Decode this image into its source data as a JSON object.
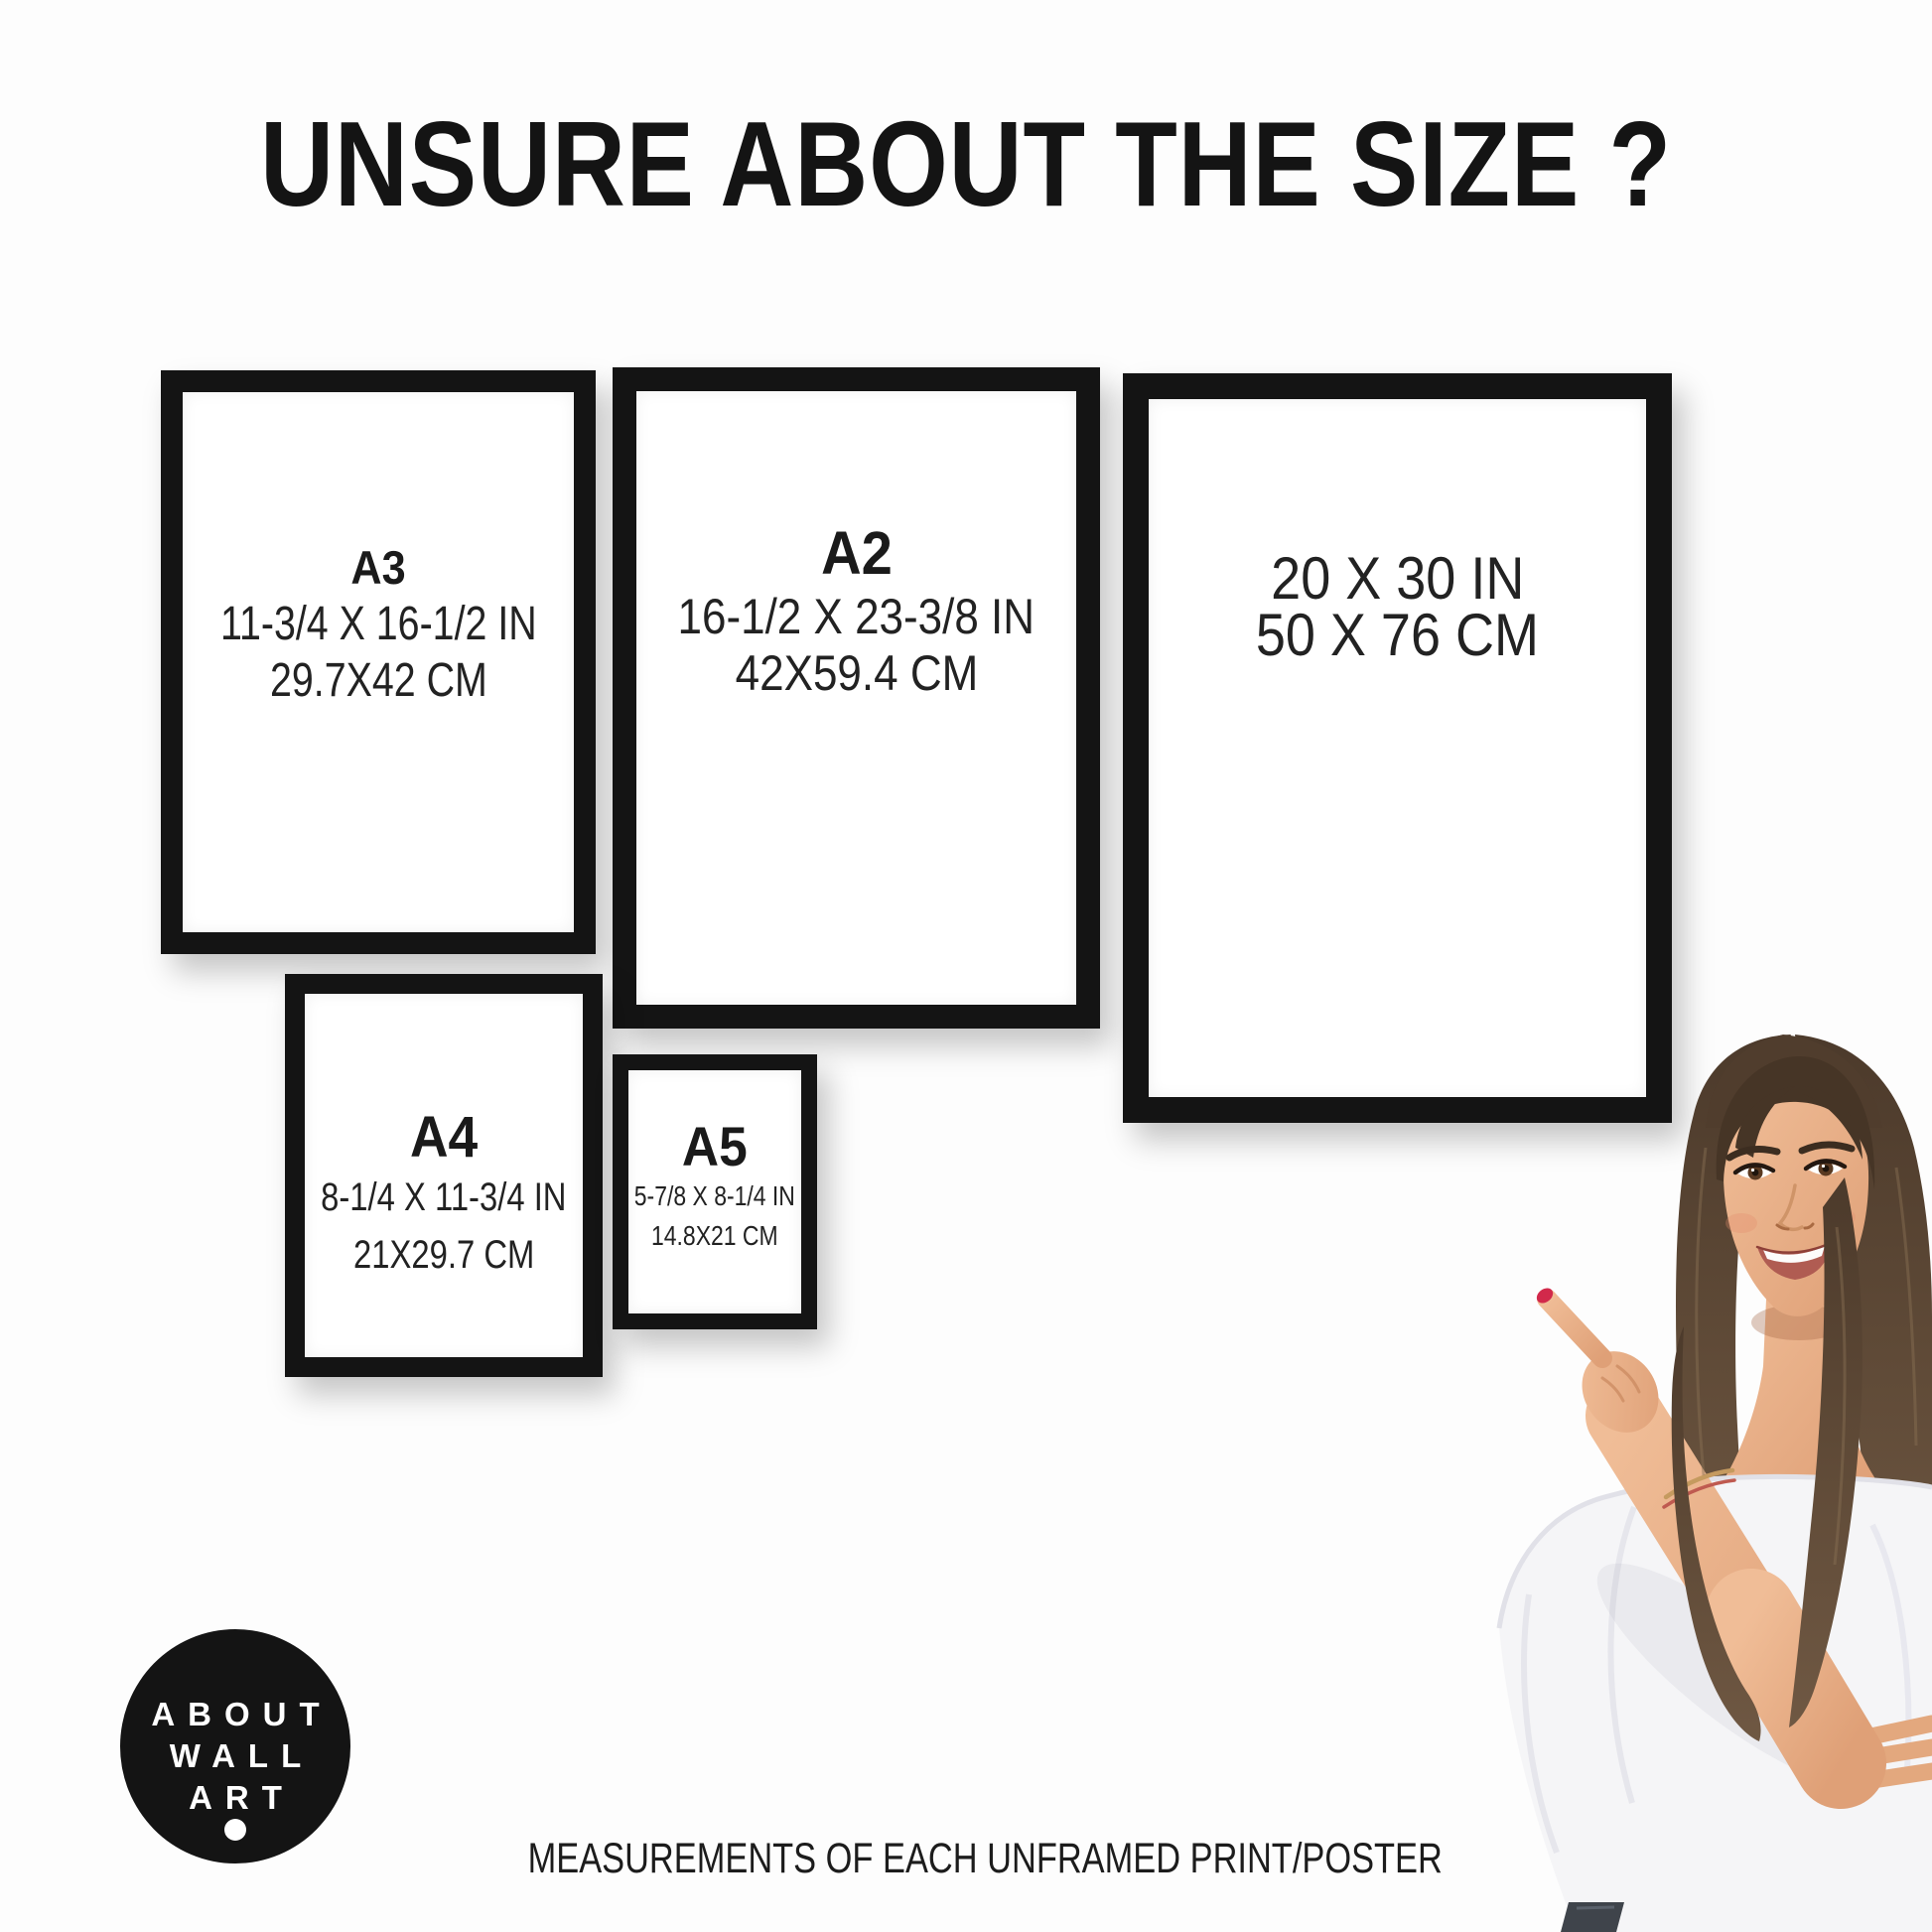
{
  "title": "UNSURE ABOUT THE SIZE ?",
  "caption": "MEASUREMENTS OF EACH UNFRAMED PRINT/POSTER",
  "logo": {
    "line1": "ABOUT",
    "line2": "WALL",
    "line3": "ART"
  },
  "frames": {
    "a3": {
      "label": "A3",
      "inches": "11-3/4 X 16-1/2 IN",
      "cm": "29.7X42 CM"
    },
    "a2": {
      "label": "A2",
      "inches": "16-1/2 X 23-3/8 IN",
      "cm": "42X59.4 CM"
    },
    "size2030": {
      "inches": "20 X 30 IN",
      "cm": "50 X 76 CM"
    },
    "a4": {
      "label": "A4",
      "inches": "8-1/4 X 11-3/4 IN",
      "cm": "21X29.7 CM"
    },
    "a5": {
      "label": "A5",
      "inches": "5-7/8 X 8-1/4 IN",
      "cm": "14.8X21 CM"
    }
  },
  "colors": {
    "frame_black": "#141414",
    "text": "#1d1d1d",
    "background": "#fdfdfd",
    "logo_bg": "#141414",
    "logo_text": "#ffffff",
    "nail_red": "#d2294b",
    "hair_brown": "#55412f",
    "skin": "#e9b28c",
    "blouse_white": "#f5f5f7",
    "jeans": "#3f444b"
  }
}
